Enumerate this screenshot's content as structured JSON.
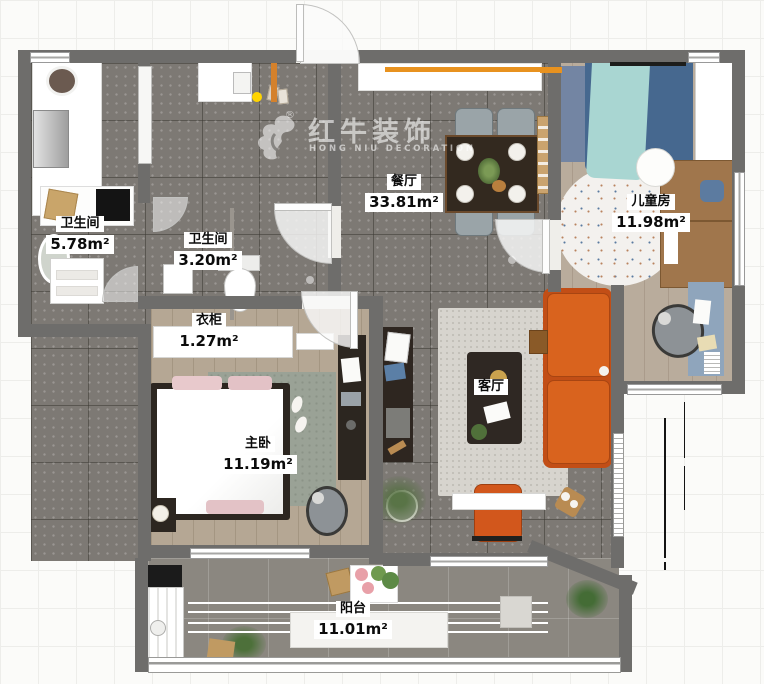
{
  "watermark": {
    "brand": "红牛装饰",
    "sub": "HONG NIU DECORATION",
    "reg": "®"
  },
  "rooms": {
    "bathroom1": {
      "name": "卫生间",
      "area": "5.78m²"
    },
    "bathroom2": {
      "name": "卫生间",
      "area": "3.20m²"
    },
    "dining": {
      "name": "餐厅",
      "area": "33.81m²"
    },
    "kids": {
      "name": "儿童房",
      "area": "11.98m²"
    },
    "wardrobe": {
      "name": "衣柜",
      "area": "1.27m²"
    },
    "master": {
      "name": "主卧",
      "area": "11.19m²"
    },
    "living": {
      "name": "客厅"
    },
    "balcony": {
      "name": "阳台",
      "area": "11.01m²"
    }
  },
  "colors": {
    "wall": "#6e6d6b",
    "tile_floor": "#7d7974",
    "wood_floor": "#b5a794",
    "sofa_orange": "#d2571c",
    "accent_orange": "#e8921f",
    "kids_bed_blue": "#46688f",
    "kids_blanket_teal": "#a9d6d2",
    "label_bg": "#ffffff",
    "marker_yellow": "#ffd400"
  }
}
